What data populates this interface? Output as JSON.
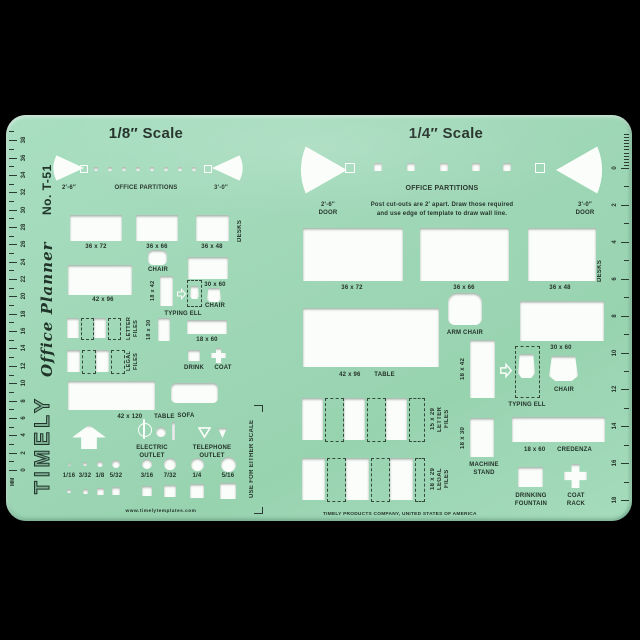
{
  "colors": {
    "background": "#000000",
    "template_green": "#a2dabb",
    "ink": "#243229",
    "cutout_white": "#fbfdfa"
  },
  "brand": {
    "name": "TIMELY",
    "script": "Office Planner",
    "model": "No. T-51",
    "website": "www.timelytemplates.com",
    "manufacturer": "TIMELY PRODUCTS COMPANY, UNITED STATES OF AMERICA"
  },
  "left_ruler": {
    "unit": "MM",
    "numbers": [
      0,
      2,
      4,
      6,
      8,
      10,
      12,
      14,
      16,
      18,
      20,
      22,
      24,
      26,
      28,
      30,
      32,
      34,
      36,
      38
    ]
  },
  "right_ruler": {
    "numbers": [
      0,
      2,
      4,
      6,
      8,
      10,
      12,
      14,
      16,
      18
    ]
  },
  "eighth": {
    "title": "1/8″ Scale",
    "partitions": {
      "heading": "OFFICE PARTITIONS",
      "left": "2′-6″",
      "right": "3′-0″"
    },
    "desks": {
      "labels": [
        "36 x 72",
        "36 x 66",
        "36 x 48"
      ],
      "side": "DESKS"
    },
    "chair1": "CHAIR",
    "table42x96": "42 x 96",
    "r18x42": "18 x 42",
    "r30x60": "30 x 60",
    "chair2": "CHAIR",
    "typing_ell": "TYPING ELL",
    "letter_files": [
      "LETTER",
      "FILES"
    ],
    "r18x30": "18 x 30",
    "r18x60": "18 x 60",
    "legal_files": [
      "LEGAL",
      "FILES"
    ],
    "drink": "DRINK",
    "coat": "COAT",
    "table120": {
      "size": "42 x 120",
      "word": "TABLE"
    },
    "sofa": "SOFA",
    "electric": [
      "ELECTRIC",
      "OUTLET"
    ],
    "telephone": [
      "TELEPHONE",
      "OUTLET"
    ],
    "fractions": [
      "1/16",
      "3/32",
      "1/8",
      "5/32",
      "3/16",
      "7/32",
      "1/4",
      "5/16"
    ],
    "either_scale": "USE FOR EITHER SCALE"
  },
  "quarter": {
    "title": "1/4″ Scale",
    "partitions": {
      "heading": "OFFICE PARTITIONS",
      "left1": "2′-6″",
      "left2": "DOOR",
      "right1": "3′-0″",
      "right2": "DOOR",
      "note1": "Post cut-outs are 2′ apart. Draw those required",
      "note2": "and use edge of template to draw wall line."
    },
    "desks": {
      "labels": [
        "36 x 72",
        "36 x 66",
        "36 x 48"
      ],
      "side": "DESKS"
    },
    "arm_chair": "ARM CHAIR",
    "table": {
      "size": "42 x 96",
      "word": "TABLE"
    },
    "r18x42": "18 x 42",
    "typing_ell": "TYPING ELL",
    "r30x60": "30 x 60",
    "chair": "CHAIR",
    "letter_files": [
      "15 x 29",
      "LETTER",
      "FILES"
    ],
    "r18x30": "18 x 30",
    "machine_stand": [
      "MACHINE",
      "STAND"
    ],
    "credenza": {
      "size": "18 x 60",
      "word": "CREDENZA"
    },
    "legal_files": [
      "18 x 29",
      "LEGAL",
      "FILES"
    ],
    "drinking": [
      "DRINKING",
      "FOUNTAIN"
    ],
    "coat_rack": [
      "COAT",
      "RACK"
    ]
  }
}
